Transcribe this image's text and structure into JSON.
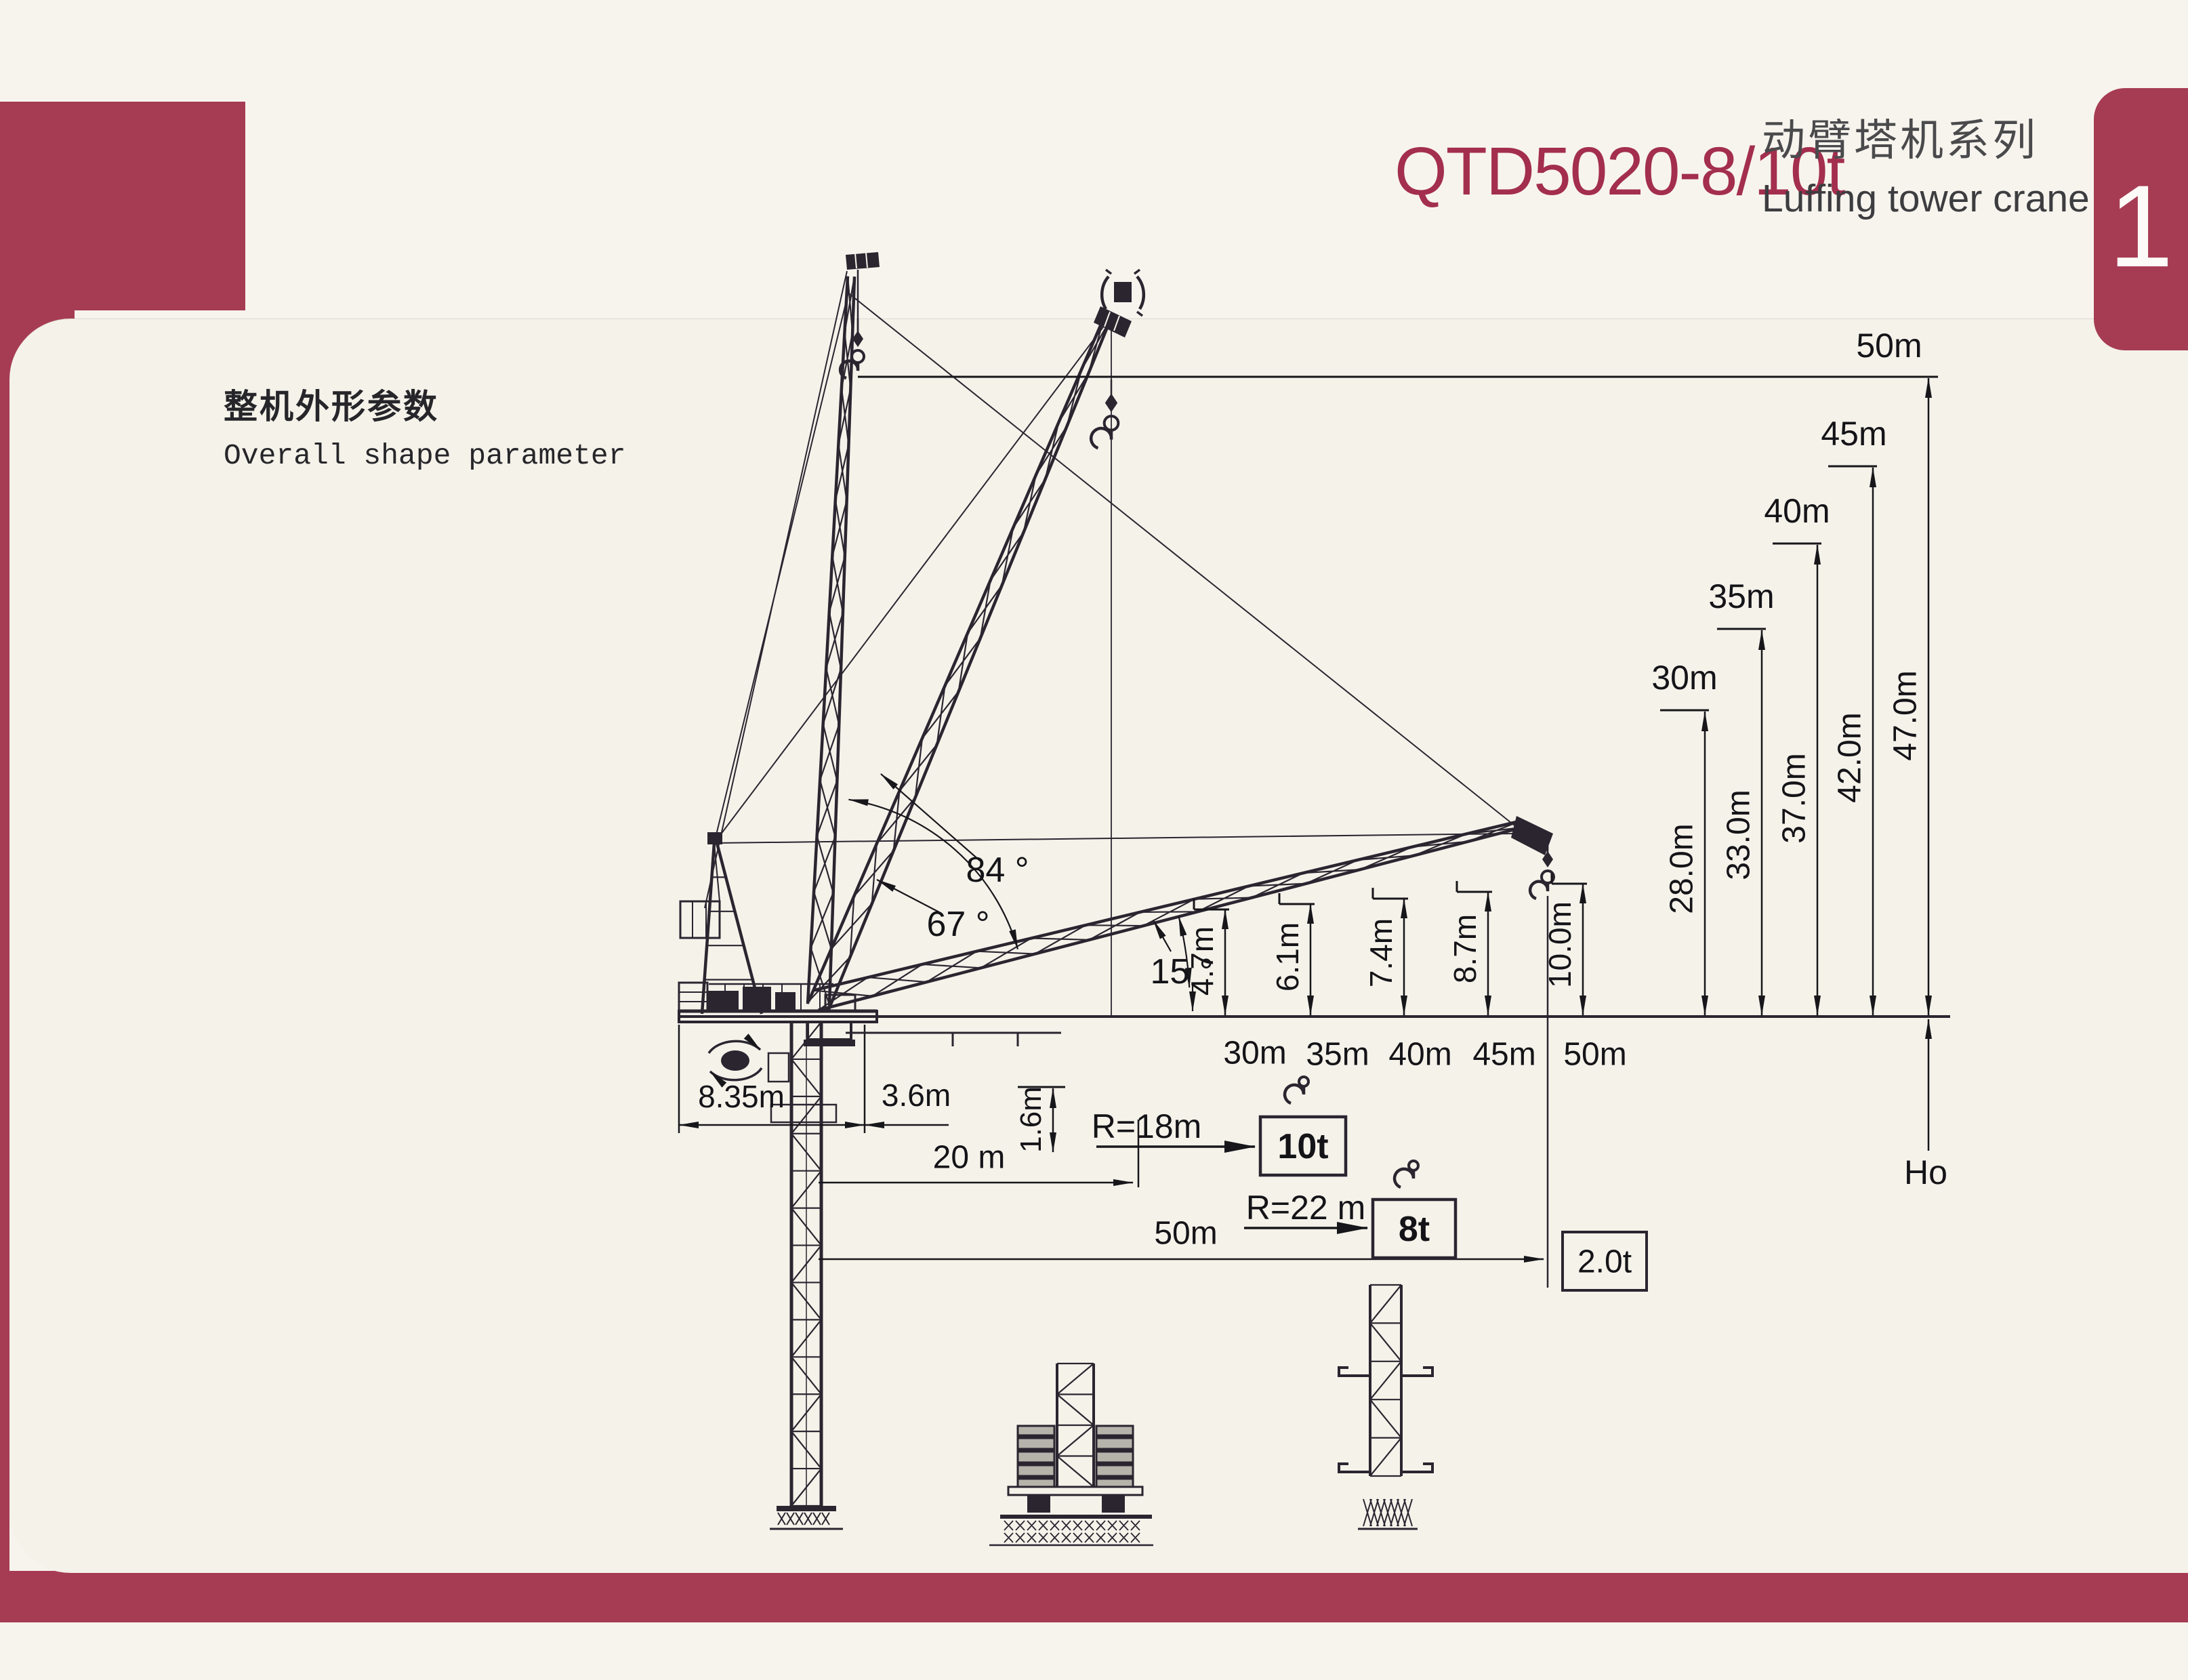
{
  "page": {
    "badge_number": "1"
  },
  "header": {
    "model": "QTD5020-8/10t",
    "series_cn": "动臂塔机系列",
    "series_en": "Luffing tower crane"
  },
  "section": {
    "title_cn": "整机外形参数",
    "title_en": "Overall shape parameter"
  },
  "diagram": {
    "angles": [
      "84 °",
      "67 °",
      "15 °"
    ],
    "hook_heights": [
      {
        "radius": "30m",
        "height": "28.0m"
      },
      {
        "radius": "35m",
        "height": "33.0m"
      },
      {
        "radius": "40m",
        "height": "37.0m"
      },
      {
        "radius": "45m",
        "height": "42.0m"
      },
      {
        "radius": "50m",
        "height": "47.0m"
      }
    ],
    "jib_clearances": [
      {
        "radius": "30m",
        "value": "4.7m"
      },
      {
        "radius": "35m",
        "value": "6.1m"
      },
      {
        "radius": "40m",
        "value": "7.4m"
      },
      {
        "radius": "45m",
        "value": "8.7m"
      },
      {
        "radius": "50m",
        "value": "10.0m"
      }
    ],
    "counterjib_tail_radius": "8.35m",
    "rear_offset": "3.6m",
    "platform_height": "1.6m",
    "mid_radius": "20 m",
    "max_radius": "50m",
    "capacity_notes": [
      {
        "radius_label": "R=18m",
        "capacity": "10t"
      },
      {
        "radius_label": "R=22 m",
        "capacity": "8t"
      }
    ],
    "tip_capacity": "2.0t",
    "base_height_label": "Ho",
    "icons": {
      "hook": "hook-icon",
      "slewing": "rotation-arrows-icon"
    },
    "colors": {
      "accent_red": "#a63c53",
      "line": "#2b2530",
      "paper": "#f5f2ea"
    }
  }
}
